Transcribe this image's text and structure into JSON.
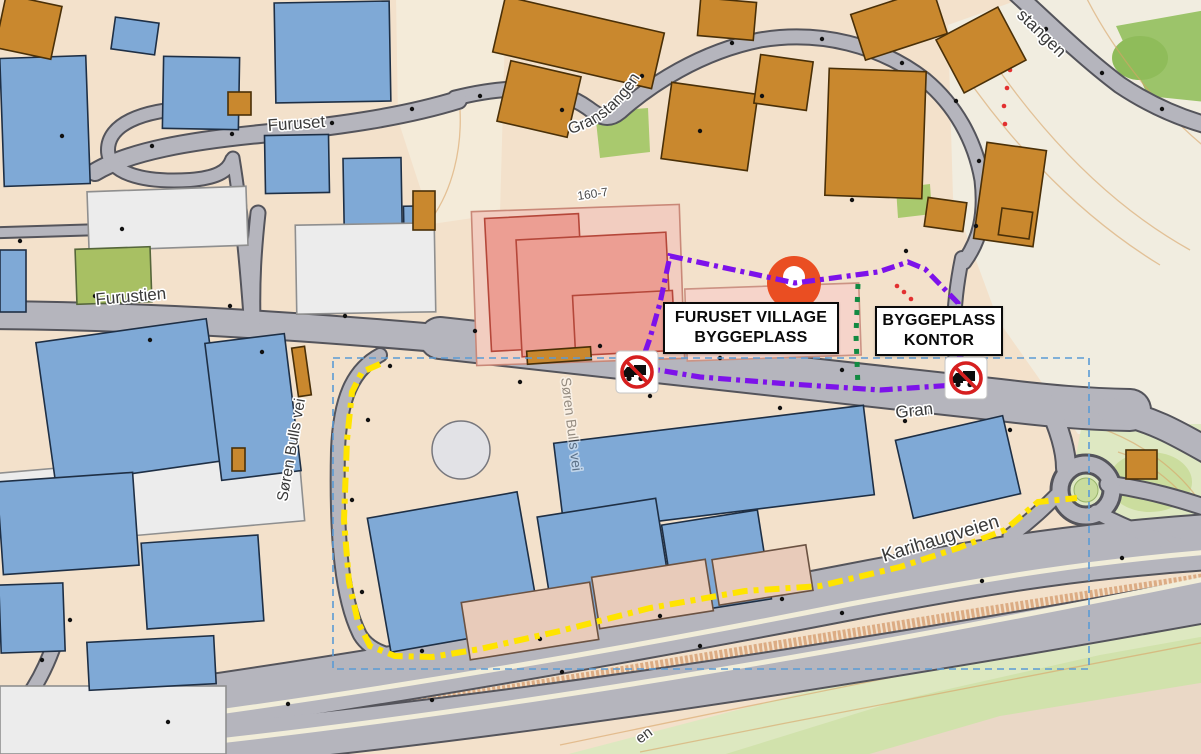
{
  "map": {
    "region_labels": [
      {
        "id": "construction-site",
        "lines": [
          "FURUSET VILLAGE",
          "BYGGEPLASS"
        ]
      },
      {
        "id": "site-office",
        "lines": [
          "BYGGEPLASS",
          "KONTOR"
        ]
      }
    ],
    "street_labels": [
      {
        "name": "furuset",
        "text": "Furuset",
        "x": 268,
        "y": 131,
        "rot": -4,
        "size": 17
      },
      {
        "name": "furustien",
        "text": "Furustien",
        "x": 96,
        "y": 305,
        "rot": -5,
        "size": 17
      },
      {
        "name": "granstangen",
        "text": "Granstangen",
        "path": "M 570,134 Q 624,120 654,50",
        "size": 16
      },
      {
        "name": "granstangen-upper",
        "text": "stangen",
        "x": 1016,
        "y": 16,
        "rot": 44,
        "size": 17
      },
      {
        "name": "soren-bulls-vei",
        "text": "Søren Bulls vei",
        "x": 287,
        "y": 502,
        "rot": -80,
        "size": 15.5
      },
      {
        "name": "soren-bulls-vei-2",
        "text": "Søren Bulls vei",
        "x": 561,
        "y": 378,
        "rot": 83,
        "size": 14,
        "opacity": 0.5
      },
      {
        "name": "gran",
        "text": "Gran",
        "x": 896,
        "y": 418,
        "rot": -6,
        "size": 17
      },
      {
        "name": "karihaugveien",
        "text": "Karihaugveien",
        "x": 884,
        "y": 562,
        "rot": -17,
        "size": 19
      },
      {
        "name": "plot-number",
        "text": "160-7",
        "x": 578,
        "y": 200,
        "rot": -8,
        "size": 12,
        "color": "#4a4a4a"
      },
      {
        "name": "street-partial",
        "text": "en",
        "x": 640,
        "y": 744,
        "rot": -36,
        "size": 15
      }
    ],
    "icons": [
      {
        "name": "no-trucks-icon",
        "x": 637,
        "y": 372
      },
      {
        "name": "no-trucks-icon",
        "x": 966,
        "y": 378
      },
      {
        "name": "location-marker-pin",
        "x": 794,
        "y": 283
      }
    ]
  },
  "colors": {
    "bg": "#F3E1CB",
    "road": "#B5B5BD",
    "casing": "#54545B",
    "separator": "#F1EDD9",
    "blue": "#7FA9D6",
    "blueStroke": "#1E2F45",
    "orange": "#C9882E",
    "orangeStroke": "#4A3008",
    "pink": "#EC9E93",
    "pinkStroke": "#B5473A",
    "pinkground": "#F2CDC0",
    "pinkpale": "#F6D4CA",
    "white": "#ECECEC",
    "whiteStroke": "#8F8F8F",
    "green": "#A8C063",
    "tan": "#E8CBBA",
    "purple": "#7D12EA",
    "yellow": "#FFE400",
    "greenDot": "#128A42",
    "selection": "#5B9BD5",
    "labelText": "#3A3A3A",
    "marker": "#EA4E22",
    "sign": "#D61F1F",
    "contour": "#D9A466",
    "slope": "#C9824B"
  },
  "routes": [
    {
      "name": "route-purple-site-boundary",
      "color": "#7D12EA",
      "width": 5.2,
      "dash": "13 5 4 5",
      "closed": true,
      "points": [
        [
          670,
          256
        ],
        [
          795,
          283
        ],
        [
          878,
          272
        ],
        [
          908,
          262
        ],
        [
          925,
          269
        ],
        [
          958,
          303
        ],
        [
          957,
          350
        ],
        [
          966,
          370
        ],
        [
          955,
          385
        ],
        [
          880,
          390
        ],
        [
          790,
          384
        ],
        [
          700,
          377
        ],
        [
          640,
          367
        ],
        [
          650,
          338
        ],
        [
          660,
          303
        ]
      ]
    },
    {
      "name": "route-yellow-detour",
      "color": "#FFE400",
      "width": 6,
      "dash": "15 6 5 6",
      "closed": false,
      "points": [
        [
          380,
          364
        ],
        [
          362,
          372
        ],
        [
          352,
          392
        ],
        [
          347,
          440
        ],
        [
          344,
          520
        ],
        [
          349,
          582
        ],
        [
          358,
          622
        ],
        [
          370,
          646
        ],
        [
          395,
          656
        ],
        [
          432,
          657
        ],
        [
          480,
          649
        ],
        [
          560,
          631
        ],
        [
          650,
          608
        ],
        [
          745,
          591
        ],
        [
          820,
          586
        ],
        [
          900,
          567
        ],
        [
          958,
          548
        ],
        [
          1005,
          530
        ],
        [
          1026,
          512
        ],
        [
          1038,
          502
        ],
        [
          1077,
          498
        ]
      ]
    },
    {
      "name": "route-green-gate",
      "color": "#128A42",
      "width": 5,
      "dash": "5 8",
      "closed": false,
      "points": [
        [
          858,
          284
        ],
        [
          856,
          335
        ],
        [
          858,
          388
        ]
      ]
    }
  ],
  "selection_rect": {
    "x": 333,
    "y": 358,
    "w": 756,
    "h": 311
  },
  "red_trails": [
    [
      [
        897,
        286
      ],
      [
        904,
        292
      ],
      [
        911,
        299
      ]
    ],
    [
      [
        1010,
        34
      ],
      [
        1012,
        52
      ],
      [
        1010,
        70
      ],
      [
        1007,
        88
      ],
      [
        1004,
        106
      ],
      [
        1005,
        124
      ]
    ]
  ],
  "zones": [
    {
      "name": "terrain-open",
      "points": "948,25 1035,-6 1206,-6 1206,434 1078,434 998,320 953,198",
      "fill": "#F1EDE0"
    },
    {
      "name": "terrain-open-2",
      "points": "396,-4 506,-4 500,214 432,224 398,120",
      "fill": "#F4EDDE",
      "opacity": 0.75
    },
    {
      "name": "forest-topright",
      "points": "1116,26 1206,10 1206,102 1148,96",
      "fill": "#9CC46A"
    },
    {
      "name": "forest-blob",
      "cx": 1140,
      "cy": 58,
      "rx": 28,
      "ry": 22,
      "fill": "#8FBC5A"
    },
    {
      "name": "hill-right",
      "points": "1082,424 1206,424 1206,562 1104,548 1066,508",
      "fill": "#DEE8C2"
    },
    {
      "name": "hill-right-core",
      "cx": 1150,
      "cy": 482,
      "rx": 42,
      "ry": 30,
      "fill": "#CBDD9E"
    },
    {
      "name": "terrain-bottom",
      "points": "538,762 760,704 1000,640 1206,600 1206,762",
      "fill": "#DDE8C0"
    },
    {
      "name": "terrain-bottom-bright",
      "points": "700,762 900,700 1100,655 1206,636 1206,762",
      "fill": "#CFE0A8",
      "opacity": 0.85
    },
    {
      "name": "terrain-bottom-pink",
      "points": "842,762 1000,716 1206,682 1206,762",
      "fill": "#EFD6CA",
      "opacity": 0.85
    },
    {
      "name": "park-mid",
      "points": "595,112 648,108 650,152 600,158",
      "fill": "#A9C96E"
    },
    {
      "name": "park-small",
      "points": "896,188 930,184 932,214 898,218",
      "fill": "#A9C96E"
    }
  ],
  "contours": [
    "M 948,50 C 1000,130 1070,210 1160,265",
    "M 975,35 C 1030,120 1100,200 1190,250",
    "M 1085,-5 C 1115,55 1165,115 1206,148",
    "M 1100,428 C 1140,442 1180,470 1202,505",
    "M 1118,452 C 1150,462 1180,486 1198,515",
    "M 560,745 C 800,695 1050,645 1206,618",
    "M 640,752 C 850,710 1100,662 1206,642",
    "M 432,218 C 452,190 462,150 460,110"
  ],
  "slope_band": "M 295,722 C 600,678 900,622 1206,578",
  "trails": [
    "M 96,252 L 205,220"
  ],
  "roads": [
    {
      "d": "M -12,315 C 150,316 300,326 460,340",
      "w": 26
    },
    {
      "d": "M 440,338 C 650,360 850,382 1000,400 C 1050,406 1085,409 1130,410",
      "w": 40
    },
    {
      "d": "M 1110,410 C 1150,418 1175,432 1210,452",
      "w": 24
    },
    {
      "d": "M 1048,404 C 1060,430 1066,452 1066,468",
      "w": 18
    },
    {
      "d": "M 258,213 C 254,250 252,280 253,322",
      "w": 13
    },
    {
      "d": "M 380,355 C 352,370 340,400 338,450 C 336,540 342,600 360,635 C 372,655 400,660 440,658 C 530,652 640,625 760,602 C 830,589 870,584 908,577",
      "w": 12
    },
    {
      "d": "M 455,98 C 520,82 560,88 588,108 C 600,117 608,122 620,112 C 650,85 700,52 760,40 C 820,30 880,45 925,80 C 955,105 975,140 982,180 C 986,215 980,240 964,262",
      "w": 13
    },
    {
      "d": "M 962,258 C 955,292 951,330 957,368 C 960,386 967,396 975,401",
      "w": 12
    },
    {
      "d": "M 1010,-12 C 1040,15 1080,55 1120,85 C 1150,105 1180,118 1210,126",
      "w": 15
    },
    {
      "d": "M 95,172 C 130,151 190,141 260,134 C 330,127 400,118 458,100",
      "w": 16
    },
    {
      "d": "M 193,108 C 140,110 108,125 108,150 C 108,172 140,183 190,180 C 215,178 228,172 232,160",
      "w": 12
    },
    {
      "d": "M -12,233 L 152,228",
      "w": 9
    },
    {
      "d": "M 233,158 C 240,200 246,262 250,316",
      "w": 11
    },
    {
      "d": "M -12,733 C 250,700 550,650 850,592 C 1000,563 1090,550 1210,542",
      "w": 54
    },
    {
      "d": "M -12,762 C 300,745 700,692 1210,600",
      "w": 42
    },
    {
      "d": "M 1010,536 C 1032,520 1046,506 1058,494",
      "w": 13
    },
    {
      "d": "M 1108,484 C 1150,490 1180,499 1210,509",
      "w": 15
    },
    {
      "d": "M 1096,512 C 1130,530 1165,543 1210,553",
      "w": 13
    },
    {
      "d": "M 55,642 C 42,680 22,712 -8,733",
      "w": 13
    }
  ],
  "separators": [
    {
      "d": "M -12,741 C 250,712 550,664 850,604 C 1000,576 1090,562 1210,552",
      "w": 5
    },
    {
      "d": "M 60,757 C 400,727 800,662 1210,578",
      "w": 5
    }
  ],
  "roundabout": {
    "cx": 1086,
    "cy": 490,
    "r": 26
  },
  "buildings": [
    {
      "x": 2,
      "y": 57,
      "w": 86,
      "h": 128,
      "r": -2,
      "c": "blue"
    },
    {
      "x": 275,
      "y": 2,
      "w": 115,
      "h": 100,
      "r": -1,
      "c": "blue"
    },
    {
      "x": 163,
      "y": 57,
      "w": 76,
      "h": 72,
      "r": 1,
      "c": "blue"
    },
    {
      "x": 113,
      "y": 20,
      "w": 44,
      "h": 32,
      "r": 8,
      "c": "blue"
    },
    {
      "x": 265,
      "y": 135,
      "w": 64,
      "h": 58,
      "r": -1,
      "c": "blue"
    },
    {
      "x": 344,
      "y": 158,
      "w": 58,
      "h": 116,
      "r": -1,
      "c": "blue"
    },
    {
      "x": 404,
      "y": 206,
      "w": 26,
      "h": 62,
      "r": -1,
      "c": "blue"
    },
    {
      "x": 0,
      "y": 250,
      "w": 26,
      "h": 62,
      "r": 0,
      "c": "blue"
    },
    {
      "x": 88,
      "y": 189,
      "w": 159,
      "h": 59,
      "r": -2,
      "c": "white"
    },
    {
      "x": 296,
      "y": 224,
      "w": 139,
      "h": 89,
      "r": -1,
      "c": "white"
    },
    {
      "x": 0,
      "y": 460,
      "w": 302,
      "h": 74,
      "r": -5,
      "c": "white"
    },
    {
      "x": 0,
      "y": 686,
      "w": 226,
      "h": 68,
      "r": 0,
      "c": "white"
    },
    {
      "x": 76,
      "y": 248,
      "w": 75,
      "h": 55,
      "r": -2,
      "c": "green"
    },
    {
      "x": 45,
      "y": 330,
      "w": 172,
      "h": 143,
      "r": -8,
      "c": "blue"
    },
    {
      "x": 213,
      "y": 338,
      "w": 80,
      "h": 138,
      "r": -7,
      "c": "blue"
    },
    {
      "x": 474,
      "y": 208,
      "w": 208,
      "h": 154,
      "r": -2,
      "c": "pinkground"
    },
    {
      "x": 488,
      "y": 216,
      "w": 94,
      "h": 133,
      "r": -3,
      "c": "pink"
    },
    {
      "x": 519,
      "y": 236,
      "w": 150,
      "h": 117,
      "r": -3,
      "c": "pink"
    },
    {
      "x": 574,
      "y": 293,
      "w": 100,
      "h": 60,
      "r": -3,
      "c": "pink"
    },
    {
      "x": 686,
      "y": 286,
      "w": 174,
      "h": 72,
      "r": -2,
      "c": "pinkpale"
    },
    {
      "x": 558,
      "y": 424,
      "w": 312,
      "h": 90,
      "r": -7,
      "c": "blue"
    },
    {
      "x": 903,
      "y": 427,
      "w": 110,
      "h": 80,
      "r": -13,
      "c": "blue"
    },
    {
      "x": 378,
      "y": 504,
      "w": 152,
      "h": 136,
      "r": -10,
      "c": "blue"
    },
    {
      "x": 545,
      "y": 507,
      "w": 120,
      "h": 110,
      "r": -9,
      "c": "blue"
    },
    {
      "x": 668,
      "y": 517,
      "w": 97,
      "h": 90,
      "r": -9,
      "c": "blue"
    },
    {
      "x": 0,
      "y": 477,
      "w": 136,
      "h": 93,
      "r": -4,
      "c": "blue"
    },
    {
      "x": 144,
      "y": 539,
      "w": 117,
      "h": 86,
      "r": -4,
      "c": "blue"
    },
    {
      "x": 0,
      "y": 584,
      "w": 64,
      "h": 68,
      "r": -2,
      "c": "blue"
    },
    {
      "x": 88,
      "y": 639,
      "w": 127,
      "h": 48,
      "r": -3,
      "c": "blue"
    },
    {
      "x": 465,
      "y": 592,
      "w": 130,
      "h": 58,
      "r": -9,
      "c": "tan"
    },
    {
      "x": 595,
      "y": 568,
      "w": 115,
      "h": 52,
      "r": -9,
      "c": "tan"
    },
    {
      "x": 715,
      "y": 552,
      "w": 95,
      "h": 46,
      "r": -9,
      "c": "tan"
    },
    {
      "x": 0,
      "y": 0,
      "w": 57,
      "h": 54,
      "r": 12,
      "c": "orange"
    },
    {
      "x": 228,
      "y": 92,
      "w": 23,
      "h": 23,
      "r": 0,
      "c": "orange"
    },
    {
      "x": 413,
      "y": 191,
      "w": 22,
      "h": 39,
      "r": 0,
      "c": "orange"
    },
    {
      "x": 497,
      "y": 14,
      "w": 163,
      "h": 57,
      "r": 13,
      "c": "orange"
    },
    {
      "x": 503,
      "y": 68,
      "w": 72,
      "h": 62,
      "r": 13,
      "c": "orange"
    },
    {
      "x": 666,
      "y": 88,
      "w": 87,
      "h": 77,
      "r": 8,
      "c": "orange"
    },
    {
      "x": 699,
      "y": 0,
      "w": 56,
      "h": 38,
      "r": 5,
      "c": "orange"
    },
    {
      "x": 757,
      "y": 58,
      "w": 53,
      "h": 49,
      "r": 8,
      "c": "orange"
    },
    {
      "x": 827,
      "y": 70,
      "w": 97,
      "h": 127,
      "r": 2,
      "c": "orange"
    },
    {
      "x": 856,
      "y": 0,
      "w": 86,
      "h": 48,
      "r": -18,
      "c": "orange"
    },
    {
      "x": 946,
      "y": 20,
      "w": 70,
      "h": 60,
      "r": -28,
      "c": "orange"
    },
    {
      "x": 980,
      "y": 146,
      "w": 60,
      "h": 97,
      "r": 8,
      "c": "orange"
    },
    {
      "x": 926,
      "y": 200,
      "w": 39,
      "h": 29,
      "r": 8,
      "c": "orange"
    },
    {
      "x": 1000,
      "y": 210,
      "w": 31,
      "h": 27,
      "r": 8,
      "c": "orange"
    },
    {
      "x": 1126,
      "y": 450,
      "w": 31,
      "h": 29,
      "r": 0,
      "c": "orange"
    },
    {
      "x": 232,
      "y": 448,
      "w": 13,
      "h": 23,
      "r": 0,
      "c": "orange"
    },
    {
      "x": 295,
      "y": 347,
      "w": 13,
      "h": 49,
      "r": -8,
      "c": "orange"
    },
    {
      "x": 527,
      "y": 349,
      "w": 64,
      "h": 13,
      "r": -4,
      "c": "orange"
    }
  ],
  "plaza_circle": {
    "cx": 461,
    "cy": 450,
    "r": 29
  },
  "decor_dots": [
    [
      150,
      340
    ],
    [
      262,
      352
    ],
    [
      390,
      366
    ],
    [
      520,
      382
    ],
    [
      650,
      396
    ],
    [
      780,
      408
    ],
    [
      905,
      421
    ],
    [
      1010,
      430
    ],
    [
      95,
      296
    ],
    [
      230,
      306
    ],
    [
      345,
      316
    ],
    [
      475,
      331
    ],
    [
      600,
      346
    ],
    [
      720,
      358
    ],
    [
      842,
      370
    ],
    [
      368,
      420
    ],
    [
      352,
      500
    ],
    [
      362,
      592
    ],
    [
      422,
      651
    ],
    [
      540,
      639
    ],
    [
      660,
      616
    ],
    [
      782,
      599
    ],
    [
      432,
      700
    ],
    [
      562,
      672
    ],
    [
      700,
      646
    ],
    [
      842,
      613
    ],
    [
      982,
      581
    ],
    [
      1122,
      558
    ],
    [
      168,
      722
    ],
    [
      288,
      704
    ],
    [
      480,
      96
    ],
    [
      562,
      110
    ],
    [
      642,
      76
    ],
    [
      732,
      43
    ],
    [
      822,
      39
    ],
    [
      902,
      63
    ],
    [
      956,
      101
    ],
    [
      979,
      161
    ],
    [
      976,
      226
    ],
    [
      1046,
      29
    ],
    [
      1102,
      73
    ],
    [
      1162,
      109
    ],
    [
      62,
      136
    ],
    [
      152,
      146
    ],
    [
      232,
      134
    ],
    [
      332,
      123
    ],
    [
      412,
      109
    ],
    [
      20,
      241
    ],
    [
      122,
      229
    ],
    [
      70,
      620
    ],
    [
      42,
      660
    ],
    [
      700,
      131
    ],
    [
      762,
      96
    ],
    [
      852,
      200
    ],
    [
      906,
      251
    ]
  ]
}
